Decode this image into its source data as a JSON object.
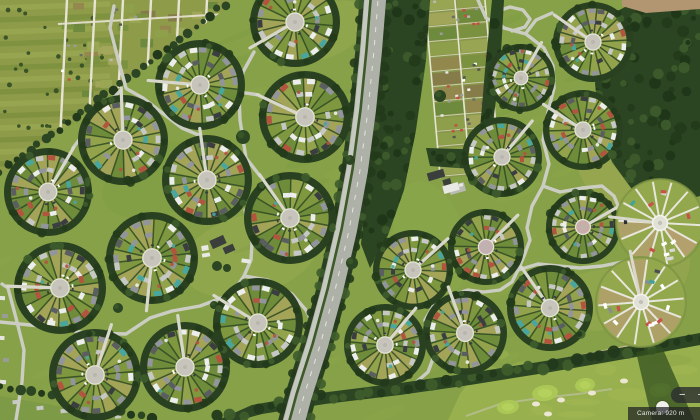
{
  "ui": {
    "zoom_out_label": "−",
    "zoom_in_label": "+",
    "attribution_text": "Camera: 920 m"
  },
  "scene": {
    "width": 700,
    "height": 420,
    "colors": {
      "grass": "#86a147",
      "grass_light": "#9db054",
      "grass_dark": "#6f9340",
      "grass_yellow": "#a6ab58",
      "hedge": "#2c4523",
      "hedge_dark": "#223a1b",
      "hedge_light": "#3d5c2b",
      "forest": "#2b4422",
      "road": "#cbcdc3",
      "path": "#d7d7cb",
      "white_path": "#e8e6da",
      "highway": "#aeb1a8",
      "lane": "#c6c9bf",
      "median": "#3e5a2b",
      "dash": "#eceee6",
      "plaza": "#c7c5bb",
      "plaza_edge": "#e6e5db",
      "sector": [
        "#6f8c3b",
        "#7f973f",
        "#93a34c",
        "#a4a458"
      ],
      "houses": [
        "#c6c8c5",
        "#92959b",
        "#5b5e60",
        "#eceded",
        "#3b3e40",
        "#c6c8c5",
        "#eceded",
        "#92959b",
        "#b3543f",
        "#49a69e"
      ],
      "cars": [
        "#ffffff",
        "#2e3133",
        "#8a8d8f",
        "#c8514a",
        "#3fa39b",
        "#d8d8d2",
        "#4a4e50",
        "#ffffff"
      ],
      "speck": [
        "#b3543f",
        "#49a69e",
        "#f0f0ec"
      ],
      "cell": [
        "#79903e",
        "#8fa04b",
        "#85794a",
        "#a3a65c",
        "#6c883c",
        "#93864e",
        "#9aa754"
      ],
      "hut": [
        "#ffffff",
        "#e8e8e4",
        "#53564f",
        "#9a9c96",
        "#c05040",
        "#b8bab4",
        "#6b6e66"
      ],
      "dirt": "#b29671",
      "golf": "#98b04d",
      "green": "#abc857",
      "bunker": "#ece7d2",
      "sand_path": "#cbbc90",
      "building_dark": "#3a3f3c",
      "building_light": "#e8e8e4",
      "parking": "#b9bbb2"
    },
    "tints": [
      [
        250,
        255,
        70,
        40,
        -15,
        "#9db054",
        0.4
      ],
      [
        160,
        180,
        60,
        35,
        -20,
        "#7e9a43",
        0.35
      ],
      [
        620,
        150,
        45,
        55,
        0,
        "#a6ab58",
        0.5
      ],
      [
        600,
        300,
        50,
        30,
        -10,
        "#9db054",
        0.4
      ],
      [
        330,
        30,
        40,
        25,
        -30,
        "#9db054",
        0.4
      ],
      [
        430,
        240,
        35,
        60,
        -15,
        "#8fae4e",
        0.3
      ],
      [
        60,
        120,
        50,
        30,
        -20,
        "#93a64e",
        0.3
      ],
      [
        660,
        260,
        30,
        40,
        0,
        "#a6ab58",
        0.4
      ]
    ],
    "allotment_west": {
      "region": [
        [
          0,
          0
        ],
        [
          229,
          0
        ],
        [
          224,
          10
        ],
        [
          0,
          176
        ]
      ],
      "hedge_line": [
        [
          226,
          4
        ],
        [
          150,
          62
        ],
        [
          75,
          118
        ],
        [
          0,
          172
        ]
      ],
      "stripe_ys": [
        8,
        20,
        32,
        44,
        56,
        68,
        80,
        92,
        104,
        116,
        128,
        140,
        152,
        164
      ],
      "vertical_xs": [
        67,
        95,
        123,
        151,
        179,
        207
      ],
      "h_path": [
        [
          58,
          24
        ],
        [
          226,
          14
        ]
      ],
      "sheds": [
        [
          197,
          160,
          12,
          6,
          -32
        ],
        [
          206,
          169,
          13,
          6,
          -32
        ],
        [
          219,
          167,
          8,
          5,
          -32
        ]
      ]
    },
    "allotment_east": {
      "rotate": [
        -5,
        462,
        82
      ],
      "rect": [
        432,
        -6,
        60,
        182
      ],
      "vxs": [
        432,
        462,
        492
      ],
      "row_step": 15
    },
    "highway": {
      "center": [
        [
          376,
          -12
        ],
        [
          371,
          50
        ],
        [
          365,
          110
        ],
        [
          357,
          170
        ],
        [
          346,
          230
        ],
        [
          332,
          290
        ],
        [
          317,
          345
        ],
        [
          301,
          395
        ],
        [
          291,
          432
        ]
      ]
    },
    "forests": [
      [
        [
          378,
          0
        ],
        [
          430,
          0
        ],
        [
          426,
          60
        ],
        [
          416,
          130
        ],
        [
          404,
          190
        ],
        [
          388,
          235
        ],
        [
          370,
          268
        ],
        [
          361,
          244
        ],
        [
          367,
          180
        ],
        [
          371,
          120
        ],
        [
          374,
          60
        ]
      ],
      [
        [
          638,
          0
        ],
        [
          700,
          0
        ],
        [
          700,
          196
        ],
        [
          664,
          206
        ],
        [
          634,
          192
        ],
        [
          612,
          162
        ],
        [
          600,
          124
        ],
        [
          595,
          84
        ],
        [
          601,
          44
        ],
        [
          612,
          14
        ]
      ],
      [
        [
          492,
          0
        ],
        [
          504,
          0
        ],
        [
          500,
          70
        ],
        [
          492,
          130
        ],
        [
          483,
          168
        ],
        [
          480,
          130
        ],
        [
          485,
          70
        ]
      ],
      [
        [
          426,
          148
        ],
        [
          492,
          150
        ],
        [
          486,
          170
        ],
        [
          430,
          166
        ]
      ]
    ],
    "tree_band": {
      "poly": [
        [
          218,
          420
        ],
        [
          252,
          405
        ],
        [
          320,
          393
        ],
        [
          400,
          383
        ],
        [
          470,
          373
        ],
        [
          545,
          361
        ],
        [
          625,
          347
        ],
        [
          700,
          333
        ],
        [
          700,
          345
        ],
        [
          625,
          359
        ],
        [
          545,
          373
        ],
        [
          470,
          385
        ],
        [
          400,
          395
        ],
        [
          325,
          404
        ],
        [
          262,
          414
        ],
        [
          240,
          420
        ]
      ],
      "spine": [
        [
          218,
          418
        ],
        [
          320,
          398
        ],
        [
          470,
          379
        ],
        [
          625,
          353
        ],
        [
          700,
          339
        ]
      ]
    },
    "hedge_bl": [
      [
        0,
        386
      ],
      [
        52,
        395
      ],
      [
        110,
        408
      ],
      [
        152,
        420
      ]
    ],
    "bl_outside": [
      [
        0,
        396
      ],
      [
        58,
        406
      ],
      [
        118,
        420
      ],
      [
        0,
        420
      ]
    ],
    "bl_houses": [
      [
        16,
        402,
        7,
        4
      ],
      [
        40,
        408,
        7,
        4
      ],
      [
        64,
        411,
        7,
        4
      ],
      [
        92,
        414,
        6,
        4
      ],
      [
        118,
        417,
        6,
        3
      ]
    ],
    "left_houses": [
      [
        2,
        298,
        6,
        4
      ],
      [
        5,
        316,
        6,
        4
      ],
      [
        2,
        338,
        5,
        4
      ],
      [
        6,
        360,
        6,
        4
      ],
      [
        3,
        382,
        6,
        4
      ]
    ],
    "golf": {
      "region": [
        [
          448,
          420
        ],
        [
          460,
          394
        ],
        [
          470,
          380
        ],
        [
          545,
          365
        ],
        [
          625,
          351
        ],
        [
          700,
          337
        ],
        [
          700,
          420
        ]
      ],
      "greens": [
        [
          545,
          393,
          13,
          8
        ],
        [
          585,
          385,
          10,
          7
        ],
        [
          508,
          407,
          11,
          7
        ],
        [
          660,
          390,
          11,
          7
        ]
      ],
      "bunkers": [
        [
          536,
          404
        ],
        [
          561,
          400
        ],
        [
          592,
          393
        ],
        [
          548,
          414
        ],
        [
          624,
          381
        ]
      ],
      "sand_path": [
        [
          478,
          376
        ],
        [
          520,
          368
        ],
        [
          570,
          358
        ],
        [
          625,
          347
        ],
        [
          668,
          340
        ]
      ],
      "walk_path": [
        [
          466,
          416
        ],
        [
          500,
          404
        ],
        [
          540,
          398
        ],
        [
          578,
          394
        ],
        [
          612,
          389
        ]
      ],
      "shadow": [
        [
          636,
          352
        ],
        [
          662,
          347
        ],
        [
          694,
          420
        ],
        [
          652,
          420
        ]
      ]
    },
    "dirt_strip": [
      [
        622,
        0
      ],
      [
        700,
        0
      ],
      [
        700,
        9
      ],
      [
        646,
        13
      ],
      [
        622,
        6
      ]
    ],
    "lone_trees": [
      [
        243,
        137,
        7
      ],
      [
        233,
        203,
        5
      ],
      [
        118,
        308,
        5
      ],
      [
        214,
        305,
        4
      ],
      [
        297,
        333,
        5
      ],
      [
        352,
        263,
        6
      ],
      [
        440,
        96,
        6
      ],
      [
        350,
        160,
        5
      ]
    ],
    "roads_west": [
      [
        [
          0,
          322
        ],
        [
          40,
          326
        ],
        [
          88,
          333
        ],
        [
          126,
          334
        ],
        [
          150,
          318
        ],
        [
          172,
          311
        ],
        [
          200,
          306
        ],
        [
          224,
          297
        ],
        [
          236,
          288
        ],
        [
          244,
          276
        ],
        [
          251,
          260
        ],
        [
          252,
          243
        ],
        [
          248,
          226
        ],
        [
          245,
          210
        ]
      ],
      [
        [
          244,
          276
        ],
        [
          268,
          280
        ],
        [
          292,
          294
        ],
        [
          306,
          310
        ],
        [
          312,
          322
        ]
      ],
      [
        [
          16,
          420
        ],
        [
          22,
          382
        ],
        [
          24,
          350
        ],
        [
          16,
          318
        ],
        [
          8,
          288
        ],
        [
          2,
          284
        ]
      ],
      [
        [
          126,
          88
        ],
        [
          117,
          55
        ],
        [
          110,
          28
        ],
        [
          114,
          6
        ]
      ],
      [
        [
          254,
          52
        ],
        [
          243,
          72
        ],
        [
          239,
          92
        ],
        [
          259,
          95
        ]
      ],
      [
        [
          73,
          148
        ],
        [
          100,
          112
        ],
        [
          121,
          90
        ]
      ],
      [
        [
          201,
          136
        ],
        [
          182,
          128
        ],
        [
          161,
          112
        ],
        [
          143,
          98
        ],
        [
          127,
          89
        ]
      ],
      [
        [
          260,
          176
        ],
        [
          246,
          158
        ],
        [
          240,
          120
        ],
        [
          239,
          94
        ]
      ]
    ],
    "roads_east": [
      [
        [
          478,
          0
        ],
        [
          486,
          18
        ],
        [
          504,
          28
        ],
        [
          526,
          34
        ],
        [
          544,
          48
        ],
        [
          553,
          66
        ],
        [
          554,
          88
        ],
        [
          548,
          112
        ],
        [
          543,
          140
        ],
        [
          549,
          164
        ],
        [
          543,
          186
        ],
        [
          532,
          206
        ],
        [
          527,
          228
        ],
        [
          530,
          240
        ],
        [
          524,
          256
        ],
        [
          518,
          270
        ],
        [
          512,
          282
        ],
        [
          500,
          290
        ],
        [
          484,
          292
        ],
        [
          468,
          290
        ],
        [
          452,
          295
        ],
        [
          434,
          305
        ],
        [
          425,
          320
        ],
        [
          426,
          340
        ],
        [
          434,
          356
        ],
        [
          428,
          372
        ],
        [
          414,
          384
        ],
        [
          398,
          391
        ]
      ],
      [
        [
          504,
          28
        ],
        [
          495,
          20
        ],
        [
          498,
          11
        ],
        [
          510,
          7
        ],
        [
          523,
          10
        ],
        [
          530,
          19
        ],
        [
          525,
          27
        ],
        [
          512,
          31
        ]
      ],
      [
        [
          543,
          186
        ],
        [
          560,
          192
        ],
        [
          582,
          188
        ],
        [
          602,
          186
        ],
        [
          614,
          196
        ],
        [
          619,
          208
        ]
      ],
      [
        [
          518,
          270
        ],
        [
          538,
          264
        ],
        [
          558,
          266
        ],
        [
          580,
          268
        ],
        [
          602,
          266
        ],
        [
          622,
          262
        ],
        [
          634,
          262
        ]
      ],
      [
        [
          552,
          13
        ],
        [
          536,
          20
        ],
        [
          526,
          33
        ]
      ]
    ],
    "circles": [
      [
        295,
        22,
        45,
        150,
        1,
        11,
        null
      ],
      [
        200,
        85,
        45,
        185,
        1,
        12,
        null
      ],
      [
        305,
        117,
        46,
        205,
        1,
        13,
        null
      ],
      [
        123,
        140,
        45,
        268,
        1,
        14,
        null
      ],
      [
        48,
        192,
        44,
        300,
        1,
        15,
        null
      ],
      [
        207,
        180,
        45,
        262,
        1,
        16,
        null
      ],
      [
        290,
        218,
        46,
        235,
        1,
        17,
        null
      ],
      [
        60,
        288,
        46,
        182,
        1,
        18,
        null
      ],
      [
        152,
        258,
        46,
        96,
        1,
        19,
        null
      ],
      [
        258,
        323,
        45,
        212,
        1,
        20,
        null
      ],
      [
        95,
        375,
        46,
        288,
        1,
        21,
        null
      ],
      [
        185,
        367,
        45,
        262,
        1,
        22,
        null
      ],
      [
        593,
        42,
        40,
        215,
        1,
        23,
        null
      ],
      [
        521,
        78,
        34,
        300,
        1,
        24,
        null
      ],
      [
        583,
        130,
        40,
        213,
        1,
        25,
        null
      ],
      [
        502,
        157,
        40,
        310,
        1,
        26,
        null
      ],
      [
        583,
        227,
        37,
        330,
        1,
        27,
        "#c8ada8"
      ],
      [
        486,
        247,
        38,
        315,
        1,
        28,
        "#c4b0b0"
      ],
      [
        413,
        270,
        40,
        318,
        1,
        29,
        null
      ],
      [
        465,
        333,
        42,
        250,
        1,
        30,
        null
      ],
      [
        550,
        308,
        43,
        235,
        1,
        31,
        null
      ],
      [
        385,
        345,
        41,
        310,
        1,
        32,
        null
      ],
      [
        660,
        223,
        44,
        187,
        0,
        33,
        null
      ],
      [
        641,
        302,
        45,
        258,
        0,
        34,
        null
      ]
    ],
    "buildings": {
      "west_dark": [
        [
          218,
          242,
          15,
          9,
          -24
        ],
        [
          229,
          249,
          11,
          7,
          -24
        ]
      ],
      "west_light": [
        [
          205,
          248,
          7,
          5,
          -10
        ],
        [
          206,
          255,
          8,
          4,
          -10
        ],
        [
          246,
          261,
          9,
          4,
          8
        ]
      ],
      "west_trees": [
        [
          217,
          266,
          5
        ],
        [
          227,
          268,
          4
        ]
      ],
      "east_dark": [
        [
          436,
          175,
          17,
          8,
          -16
        ],
        [
          447,
          182,
          8,
          6,
          -16
        ]
      ],
      "east_light": [
        [
          451,
          188,
          16,
          8,
          -16
        ],
        [
          461,
          185,
          4,
          3,
          -16
        ]
      ]
    }
  }
}
